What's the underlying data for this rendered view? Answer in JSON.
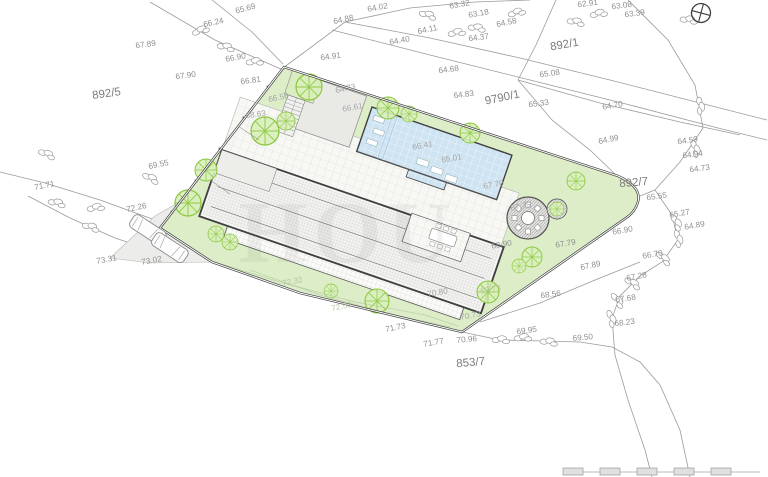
{
  "plan_type": "architectural-site-plan",
  "parcels": [
    "892/5",
    "892/1",
    "9790/1",
    "892/7",
    "853/7"
  ],
  "labels": [
    "65.69",
    "66.24",
    "67.89",
    "66.90",
    "67.90",
    "66.81",
    "64.88",
    "64.02",
    "64.91",
    "64.40",
    "64.11",
    "63.32",
    "63.18",
    "64.58",
    "64.37",
    "64.68",
    "64.83",
    "65.08",
    "62.91",
    "63.08",
    "63.39",
    "65.33",
    "64.70",
    "64.99",
    "64.59",
    "64.94",
    "64.73",
    "65.55",
    "65.27",
    "64.89",
    "66.90",
    "66.70",
    "67.89",
    "67.79",
    "67.28",
    "67.68",
    "68.23",
    "68.56",
    "68.90",
    "69.50",
    "69.95",
    "70.96",
    "71.77",
    "71.73",
    "69.55",
    "71.71",
    "72.26",
    "73.31",
    "73.02",
    "64.73",
    "66.61",
    "66.41",
    "65.01",
    "66.56",
    "68.63",
    "70.80",
    "70.73",
    "67.70",
    "67.75",
    "72.32",
    "72.50",
    "69.73"
  ],
  "watermark": "HOU",
  "icons": {
    "compass": "crosshair-circle",
    "scale_bar": "graphic-scale-5-segments",
    "tree": "deciduous-tree-symbol",
    "shrub": "rock-shrub-symbol",
    "car": "parked-car-symbol"
  },
  "colors": {
    "site_green": "#dcedc8",
    "pool_blue": "#cfe4f2",
    "paving": "#f7f7f4",
    "terrace_gray": "#e9e9e6",
    "contour_gray": "#9b9b9b",
    "boundary_dark": "#3f3f3f",
    "tree_green": "#8cc63f"
  }
}
